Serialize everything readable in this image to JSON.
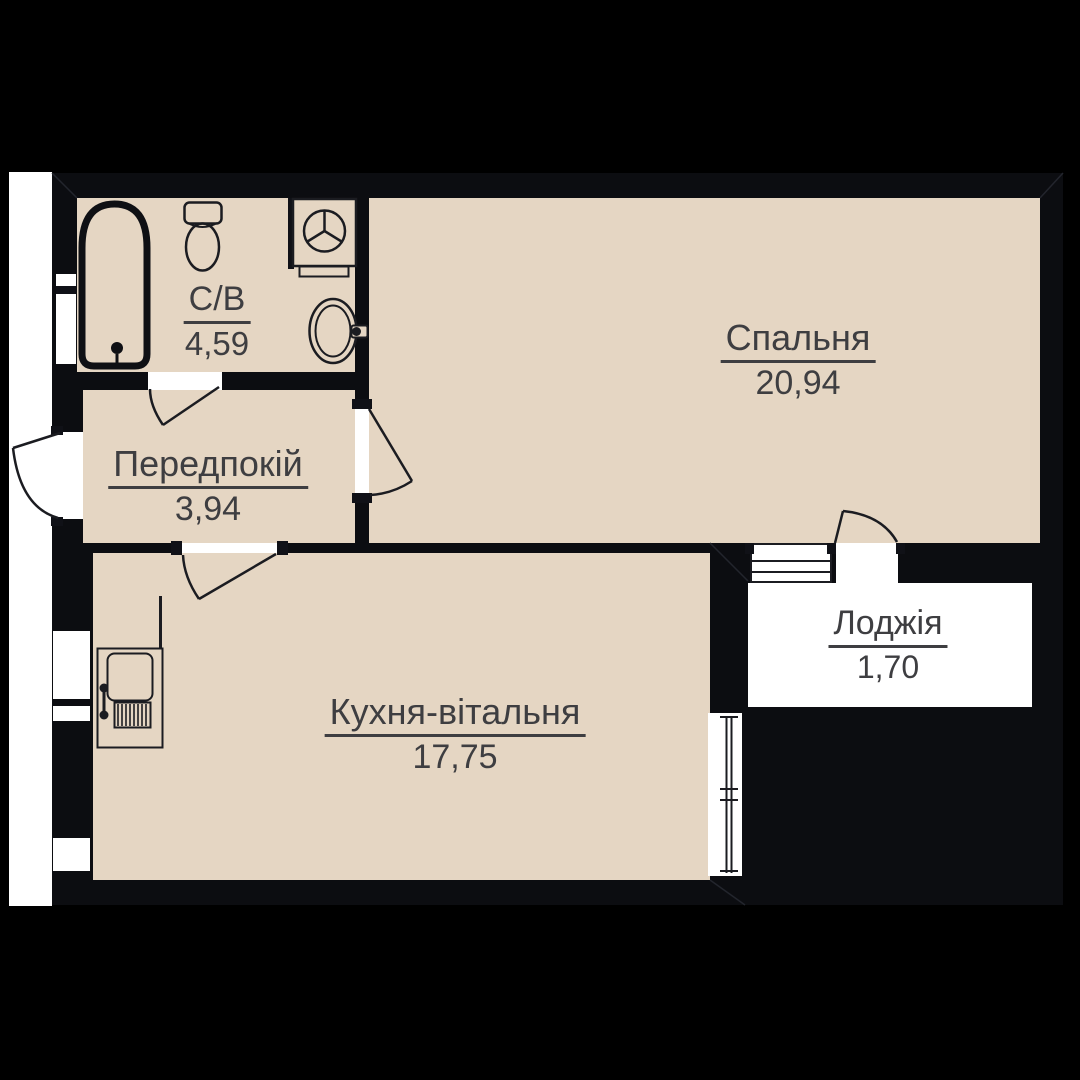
{
  "plan": {
    "type": "apartment-floor-plan",
    "rooms": [
      {
        "id": "bathroom",
        "name": "С/В",
        "area": "4,59"
      },
      {
        "id": "hallway",
        "name": "Передпокій",
        "area": "3,94"
      },
      {
        "id": "bedroom",
        "name": "Спальня",
        "area": "20,94"
      },
      {
        "id": "kitchen-living",
        "name": "Кухня-вітальня",
        "area": "17,75"
      },
      {
        "id": "loggia",
        "name": "Лоджія",
        "area": "1,70"
      }
    ],
    "fixtures": [
      "bathtub-icon",
      "toilet-icon",
      "washing-machine-icon",
      "sink-icon",
      "boiler-radiator-icon"
    ],
    "colors": {
      "background": "#000000",
      "wall": "#0c0d11",
      "floor": "#e5d6c3",
      "loggia_floor": "#ffffff",
      "outside_corridor": "#ffffff",
      "label_text": "#3e3e41",
      "line": "#1b1c21"
    }
  }
}
